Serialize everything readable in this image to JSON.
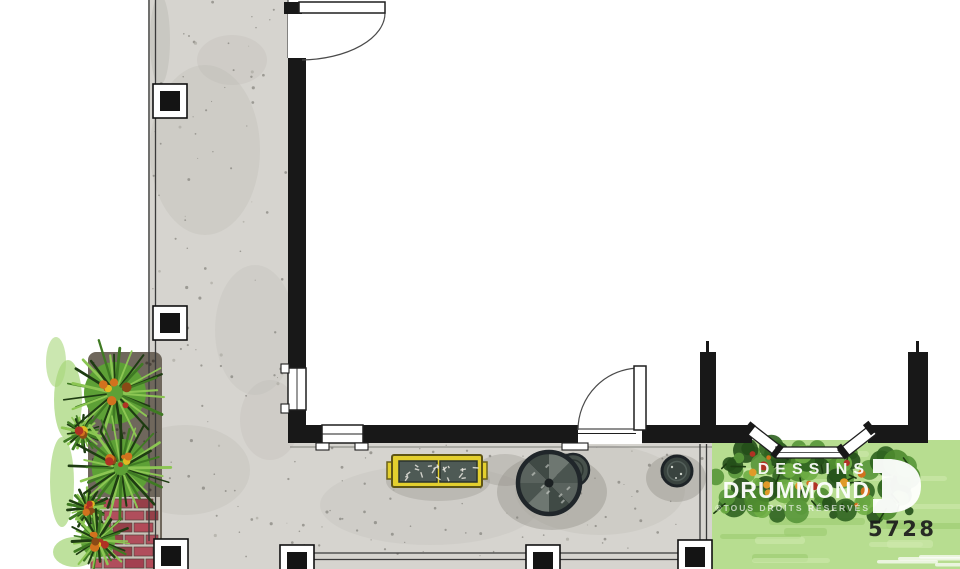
{
  "document": {
    "type": "hand-drawn watercolor floor plan",
    "subject": "L-shaped covered veranda wrapping a house corner"
  },
  "watermark": {
    "brand_line1": "DESSINS",
    "brand_line2": "DRUMMOND",
    "rights": "©TOUS DROITS RÉSERVÉS",
    "logo_letter": "D"
  },
  "plan_number": "5728",
  "features": {
    "walkway": "L-shaped concrete veranda floor with railing posts",
    "doors": 2,
    "bay_window": 1,
    "planter_box": "yellow double planter",
    "patio_set": "round table with plant pots",
    "paving": "red brick patch bottom-left",
    "vegetation": "spiky shrubs left, foundation shrubs and lawn right"
  },
  "colors": {
    "walkway": "#d6d4cf",
    "wall": "#181818",
    "planter_yellow": "#e3cf2e",
    "foliage_green": "#4c8a2e",
    "lawn_green": "#b7dd90",
    "brick_red": "#b24a58",
    "watermark": "#ffffff"
  }
}
